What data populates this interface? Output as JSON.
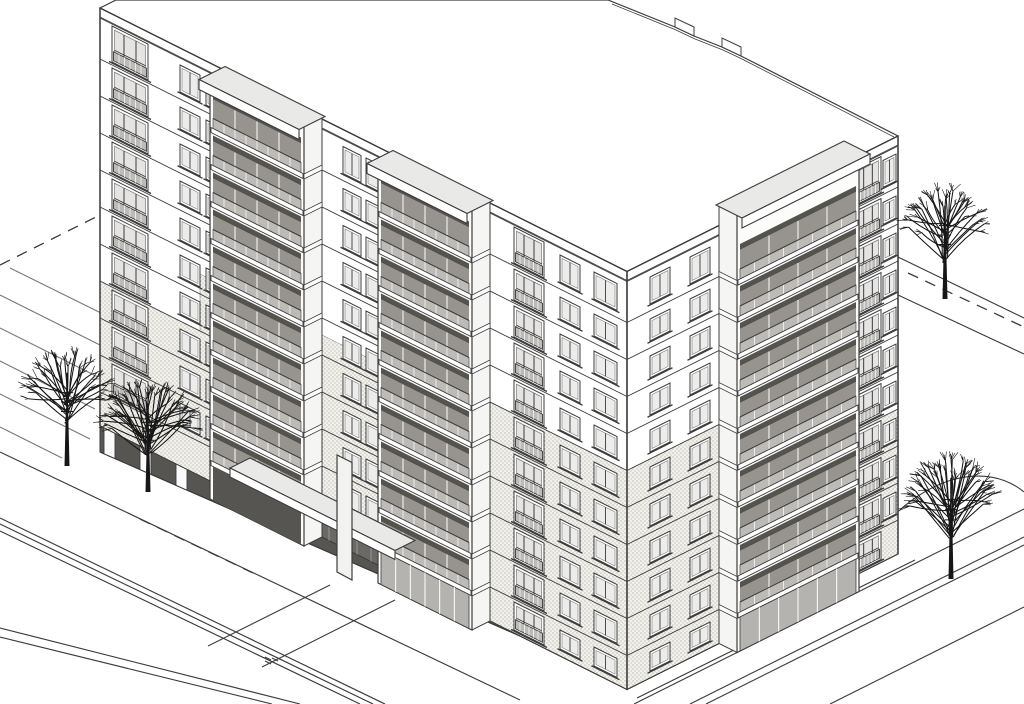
{
  "meta": {
    "title": "Axonometric architectural line drawing of an 11-storey apartment building",
    "drawing_type": "axonometric exterior view, black line on white"
  },
  "canvas": {
    "w": 1024,
    "h": 704,
    "bg": "#ffffff"
  },
  "palette": {
    "line": "#3c3c3c",
    "lineLight": "#7a7a7a",
    "paper": "#ffffff",
    "slabTop": "#e9e9e8",
    "towerSide": "#f5f5f4",
    "towerFront": "#fcfcfb",
    "railing": "#bdbbb7",
    "glass": "#97948f",
    "glassLight": "#e5e4e2",
    "lintel": "#55534e",
    "recess": "#575552",
    "entryGlass": "#6b6965",
    "lobbyGlass": "#b5b3af",
    "stippleBg": "#f2f0ea",
    "stippleDot": "#8d8a84",
    "tree": "#171717"
  },
  "axon": {
    "A": [
      100,
      8
    ],
    "B": [
      627,
      271.5
    ],
    "C": [
      898,
      136
    ],
    "slope": 0.5,
    "wallHeight": 418,
    "floorLines": [
      9,
      51,
      88,
      125,
      162,
      199,
      236,
      273,
      310,
      347,
      384,
      418
    ],
    "towerOffsetLeft": [
      -18,
      9
    ],
    "towerOffsetRight": [
      18,
      9
    ],
    "capOffsetLeft": [
      -26,
      13
    ],
    "capOffsetRight": [
      26,
      13
    ]
  },
  "roof": {
    "outline": [
      [
        116,
        0
      ],
      [
        608,
        0
      ],
      [
        675,
        27
      ],
      [
        694,
        36
      ],
      [
        722,
        47
      ],
      [
        741,
        56
      ],
      [
        898,
        136
      ],
      [
        627,
        271.5
      ],
      [
        100,
        8
      ]
    ],
    "innerParapet": [
      [
        612,
        4
      ],
      [
        676,
        30
      ],
      [
        695,
        39
      ],
      [
        723,
        50
      ],
      [
        742,
        59
      ],
      [
        894,
        137
      ]
    ],
    "backTowerCaps": [
      [
        [
          675,
          27
        ],
        [
          675,
          18
        ],
        [
          694,
          27
        ],
        [
          694,
          36
        ]
      ],
      [
        [
          722,
          47
        ],
        [
          722,
          38
        ],
        [
          741,
          47
        ],
        [
          741,
          56
        ]
      ]
    ]
  },
  "leftFacade": {
    "length": 527,
    "columns": [
      {
        "s": 12,
        "w": 36,
        "type": "A",
        "groundRow": false
      },
      {
        "s": 80,
        "w": 20,
        "type": "B",
        "groundRow": false
      },
      {
        "s": 106,
        "w": 18,
        "type": "B",
        "groundRow": false
      },
      {
        "s": 243,
        "w": 18,
        "type": "B",
        "groundRow": false
      },
      {
        "s": 266,
        "w": 24,
        "type": "B",
        "groundRow": false
      },
      {
        "s": 414,
        "w": 30,
        "type": "A",
        "groundRow": true
      },
      {
        "s": 460,
        "w": 20,
        "type": "B",
        "groundRow": true
      },
      {
        "s": 494,
        "w": 23,
        "type": "B",
        "groundRow": true
      }
    ],
    "towers": [
      {
        "s0": 128,
        "s1": 222,
        "ground": "recess",
        "capRise": 4
      },
      {
        "s0": 296,
        "s1": 390,
        "ground": "lobby",
        "capRise": 4
      }
    ],
    "stipple": [
      [
        0,
        128,
        273,
        418
      ],
      [
        100,
        128,
        216,
        273
      ],
      [
        218,
        296,
        216,
        418
      ],
      [
        390,
        527,
        199,
        418
      ]
    ],
    "pilotis": {
      "sEnd": 420,
      "drop": 26,
      "columns": [
        4,
        40,
        76,
        112
      ],
      "colW": 11
    },
    "entranceGlazing": {
      "s0": 152,
      "s1": 328,
      "y0": 381,
      "y1": 418
    }
  },
  "rightFacade": {
    "length": 271,
    "columns": [
      {
        "s": 23,
        "w": 20,
        "type": "B",
        "groundRow": true
      },
      {
        "s": 63,
        "w": 20,
        "type": "B",
        "groundRow": true
      },
      {
        "s": 228,
        "w": 26,
        "type": "A",
        "groundRow": true
      },
      {
        "s": 256,
        "w": 13,
        "type": "B",
        "groundRow": false
      }
    ],
    "tower": {
      "s0": 92,
      "s1": 214,
      "ground": "lobby",
      "capRise": 22
    },
    "stipple": [
      [
        0,
        92,
        199,
        418
      ],
      [
        218,
        271,
        273,
        418
      ]
    ],
    "lobby": {
      "s0": 96,
      "s1": 210,
      "y0": 386,
      "y1": 416,
      "doorS0": 144,
      "doorS1": 166
    }
  },
  "entrance": {
    "canopy": {
      "s0": 150,
      "s1": 315,
      "yoff": 375,
      "frontOffset": [
        -20,
        10
      ],
      "fasciaH": 9
    },
    "blade": [
      [
        337,
        455
      ],
      [
        352,
        462.5
      ],
      [
        352,
        580
      ],
      [
        337,
        572
      ]
    ],
    "walkway": [
      {
        "x1": 330,
        "y1": 585,
        "x2": 208,
        "y2": 646
      },
      {
        "x1": 395,
        "y1": 600,
        "x2": 262,
        "y2": 667
      }
    ]
  },
  "ground": {
    "lines": [
      {
        "x1": 898,
        "y1": 257,
        "x2": 1024,
        "y2": 318,
        "dash": false,
        "name": "road-curb-back"
      },
      {
        "x1": 908,
        "y1": 273,
        "x2": 1024,
        "y2": 327,
        "dash": true,
        "name": "road-centerline-back"
      },
      {
        "x1": 898,
        "y1": 295,
        "x2": 1024,
        "y2": 354,
        "dash": false,
        "name": "road-curb-back"
      },
      {
        "x1": 0,
        "y1": 265,
        "x2": 104,
        "y2": 213,
        "dash": true,
        "name": "road-centerline-upper-left"
      },
      {
        "x1": 10,
        "y1": 268,
        "x2": 105,
        "y2": 315,
        "dash": false,
        "name": "parking-stripe"
      },
      {
        "x1": 0,
        "y1": 295,
        "x2": 100,
        "y2": 345,
        "dash": false,
        "name": "parking-stripe"
      },
      {
        "x1": 0,
        "y1": 328,
        "x2": 98,
        "y2": 377,
        "dash": false,
        "name": "parking-stripe"
      },
      {
        "x1": 0,
        "y1": 361,
        "x2": 95,
        "y2": 409,
        "dash": false,
        "name": "parking-stripe"
      },
      {
        "x1": 0,
        "y1": 394,
        "x2": 90,
        "y2": 439,
        "dash": false,
        "name": "parking-stripe"
      },
      {
        "x1": 0,
        "y1": 427,
        "x2": 62,
        "y2": 458,
        "dash": false,
        "name": "parking-stripe"
      },
      {
        "x1": 0,
        "y1": 452,
        "x2": 520,
        "y2": 700,
        "dash": false,
        "name": "lawn-edge"
      },
      {
        "x1": 140,
        "y1": 519,
        "x2": 253,
        "y2": 573,
        "dash": true,
        "name": "setback-dashes"
      },
      {
        "x1": 0,
        "y1": 518,
        "x2": 385,
        "y2": 704,
        "dash": false,
        "name": "sidewalk-curb"
      },
      {
        "x1": 0,
        "y1": 524,
        "x2": 373,
        "y2": 704,
        "dash": false,
        "name": "sidewalk-curb"
      },
      {
        "x1": 0,
        "y1": 531,
        "x2": 360,
        "y2": 704,
        "dash": false,
        "name": "sidewalk-curb"
      },
      {
        "x1": 0,
        "y1": 628,
        "x2": 300,
        "y2": 704,
        "dash": false,
        "name": "road-edge"
      },
      {
        "x1": 0,
        "y1": 637,
        "x2": 272,
        "y2": 704,
        "dash": false,
        "name": "road-edge"
      },
      {
        "x1": 634,
        "y1": 704,
        "x2": 1024,
        "y2": 509,
        "dash": false,
        "name": "road-curb-right"
      },
      {
        "x1": 690,
        "y1": 704,
        "x2": 1024,
        "y2": 537,
        "dash": false,
        "name": "road-curb-right"
      },
      {
        "x1": 706,
        "y1": 704,
        "x2": 1024,
        "y2": 545,
        "dash": false,
        "name": "road-curb-right"
      },
      {
        "x1": 830,
        "y1": 704,
        "x2": 1024,
        "y2": 607,
        "dash": false,
        "name": "road-edge-right"
      },
      {
        "x1": 637,
        "y1": 698,
        "x2": 915,
        "y2": 560,
        "dash": false,
        "name": "sidewalk-line-right"
      },
      {
        "x1": 265,
        "y1": 657,
        "x2": 271,
        "y2": 660,
        "dash": false,
        "name": "road-mark"
      },
      {
        "x1": 265,
        "y1": 661,
        "x2": 271,
        "y2": 664,
        "dash": false,
        "name": "road-mark"
      },
      {
        "x1": 272,
        "y1": 658,
        "x2": 278,
        "y2": 661,
        "dash": false,
        "name": "road-mark"
      }
    ],
    "lawnArc": "M 862 553 C 920 470 988 462 1024 492"
  },
  "trees": [
    {
      "x": 67,
      "baseY": 466,
      "h": 118,
      "w": 86,
      "seed": 3,
      "branches": 32
    },
    {
      "x": 148,
      "baseY": 492,
      "h": 112,
      "w": 92,
      "seed": 11,
      "branches": 42
    },
    {
      "x": 945,
      "baseY": 299,
      "h": 118,
      "w": 82,
      "seed": 19,
      "branches": 32
    },
    {
      "x": 951,
      "baseY": 579,
      "h": 128,
      "w": 88,
      "seed": 27,
      "branches": 42
    }
  ]
}
